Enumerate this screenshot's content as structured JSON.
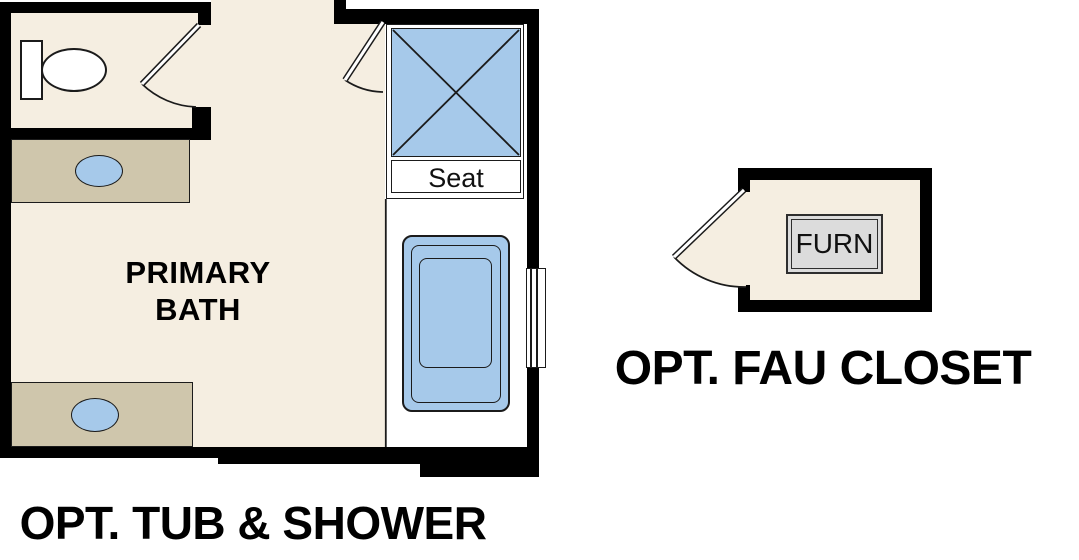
{
  "floor_plan": {
    "primary_bath": {
      "room_label_lines": [
        "PRIMARY",
        "BATH"
      ],
      "shower_seat_label": "Seat",
      "caption": "OPT. TUB & SHOWER"
    },
    "fau_closet": {
      "furnace_label": "FURN",
      "caption": "OPT. FAU CLOSET"
    },
    "fixtures": [
      "toilet",
      "vanity-sink",
      "vanity-sink",
      "shower",
      "bathtub",
      "window",
      "furnace"
    ],
    "colors": {
      "wall": "#000000",
      "floor": "#f5eee1",
      "counter": "#cfc6ac",
      "fixture_blue": "#a6c9ea",
      "furnace_fill": "#dcdcdc",
      "line": "#1b1b1b"
    }
  }
}
